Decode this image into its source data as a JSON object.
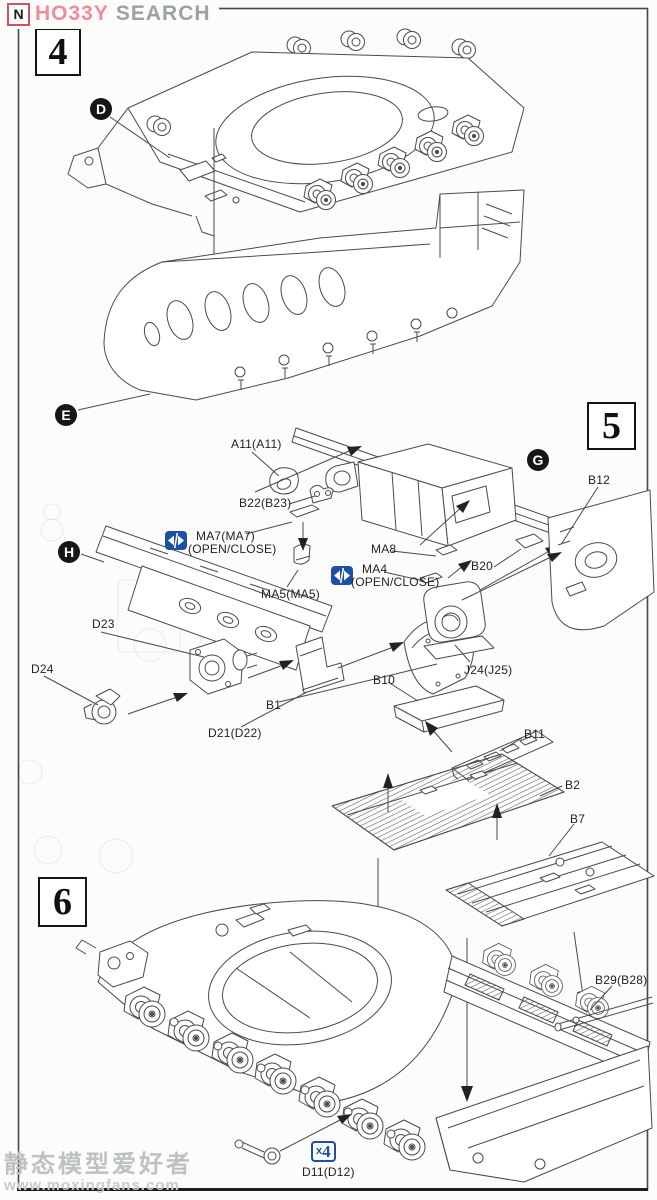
{
  "logo": {
    "icon_letter": "N",
    "brand_primary": "HO33Y",
    "brand_secondary": "SEARCH"
  },
  "steps": {
    "s4": "4",
    "s5": "5",
    "s6": "6"
  },
  "markers": {
    "d": "D",
    "e": "E",
    "g": "G",
    "h": "H"
  },
  "labels": {
    "a11": "A11(A11)",
    "b22": "B22(B23)",
    "b12": "B12",
    "ma7": "MA7(MA7)",
    "ma7_note": "(OPEN/CLOSE)",
    "ma8": "MA8",
    "ma4": "MA4",
    "ma4_note": "(OPEN/CLOSE)",
    "ma5": "MA5(MA5)",
    "b20": "B20",
    "d23": "D23",
    "d24": "D24",
    "b1": "B1",
    "d21": "D21(D22)",
    "j24": "J24(J25)",
    "b10": "B10",
    "b11": "B11",
    "b2": "B2",
    "b7": "B7",
    "b29": "B29(B28)",
    "d11": "D11(D12)"
  },
  "quantity_badge": {
    "prefix": "x",
    "value": "4"
  },
  "watermark": {
    "line1": "静态模型爱好者",
    "line2": "www.moxingfans.com"
  },
  "icons": {
    "open_close_icon": "left-right white arrows on blue square",
    "logo_mark_icon": "N in red square"
  },
  "colors": {
    "accent_blue": "#1c4fa6",
    "logo_pink": "#ee8d99",
    "logo_gray": "#9ba1a6",
    "ink": "#4a4a4a"
  }
}
